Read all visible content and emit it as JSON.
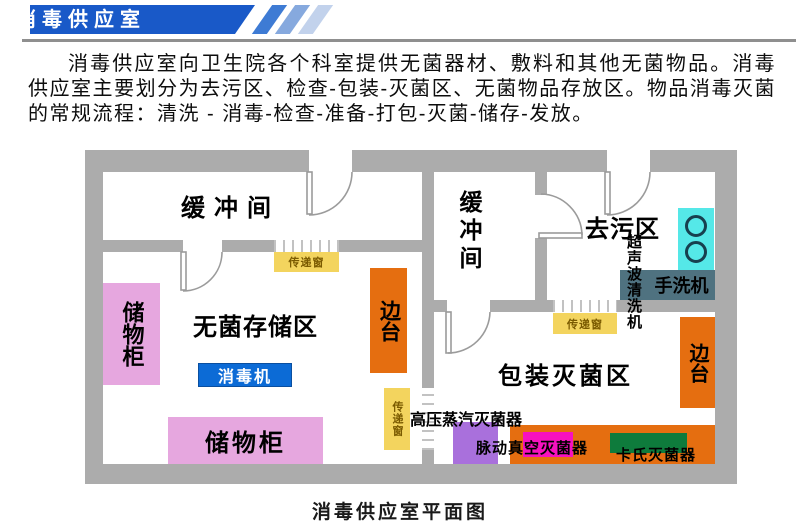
{
  "header": {
    "title": "消毒供应室"
  },
  "intro": {
    "text": "消毒供应室向卫生院各个科室提供无菌器材、敷料和其他无菌物品。消毒供应室主要划分为去污区、检查-包装-灭菌区、无菌物品存放区。物品消毒灭菌的常规流程：清洗 - 消毒-检查-准备-打包-灭菌-储存-发放。"
  },
  "caption": "消毒供应室平面图",
  "plan": {
    "rooms": {
      "buffer_left": {
        "label": "缓冲间"
      },
      "buffer_mid": {
        "label": "缓冲间"
      },
      "decontamination": {
        "label": "去污区"
      },
      "sterile_storage": {
        "label": "无菌存储区"
      },
      "packaging_sterilization": {
        "label": "包装灭菌区"
      }
    },
    "equipment": {
      "cabinet_left": {
        "label": "储物柜"
      },
      "cabinet_bottom": {
        "label": "储物柜"
      },
      "side_table_left": {
        "label": "边台"
      },
      "side_table_right": {
        "label": "边台"
      },
      "disinfector": {
        "label": "消毒机"
      },
      "ultrasonic_cleaner": {
        "label": "超声波清洗机"
      },
      "hand_washer": {
        "label": "手洗机"
      },
      "pass_window_sterile": {
        "label": "传递窗"
      },
      "pass_window_side": {
        "label": "传递窗"
      },
      "pass_window_packaging": {
        "label": "传递窗"
      },
      "autoclave": {
        "label": "高压蒸汽灭菌器"
      },
      "pulse_vacuum_sterilizer": {
        "label": "脉动真空灭菌器"
      },
      "cassette_sterilizer": {
        "label": "卡氏灭菌器"
      }
    }
  },
  "colors": {
    "wall": "#acacac",
    "headerblue": "#1959c8",
    "stripe1": "#3e7bd4",
    "stripe2": "#86a9de",
    "stripe3": "#c2d2ec",
    "cabinet": "#e6a7df",
    "sidetable": "#e56e10",
    "disinfector": "#0c6bd6",
    "sink": "#55e8e8",
    "handwasher": "#4f7280",
    "passwin": "#f3d45e",
    "passwintext": "#7a5a00",
    "autoclave": "#a970dc",
    "magenta": "#f711bf",
    "green": "#0e7b3c"
  }
}
